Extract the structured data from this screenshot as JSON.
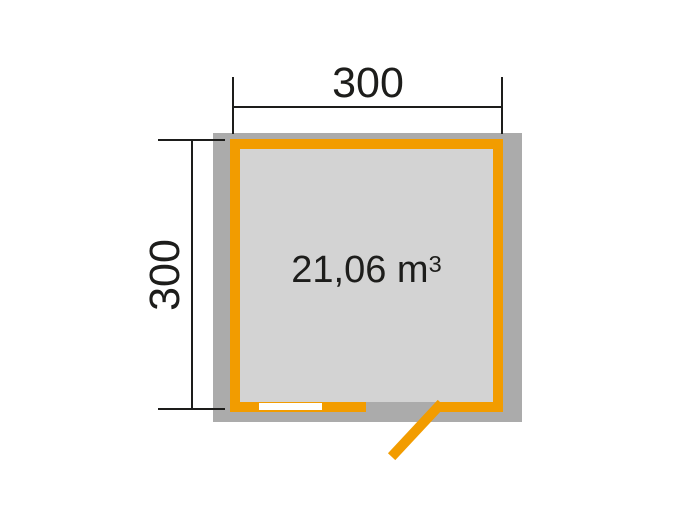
{
  "diagram": {
    "type": "floor-plan",
    "dimensions": {
      "width": {
        "label": "300"
      },
      "height": {
        "label": "300"
      }
    },
    "area": {
      "text": "21,06 m",
      "superscript": "3",
      "full": "21,06 m³"
    },
    "features": [
      {
        "name": "window",
        "position": "bottom-left"
      },
      {
        "name": "door",
        "position": "bottom-right",
        "state": "open-outward"
      }
    ],
    "colors": {
      "outer_wall": "#ABABAB",
      "inner_wall": "#F29C00",
      "floor": "#D3D3D3",
      "dimension": "#1D1D1B",
      "window": "#FFFFFF",
      "background": "#FFFFFF"
    }
  }
}
